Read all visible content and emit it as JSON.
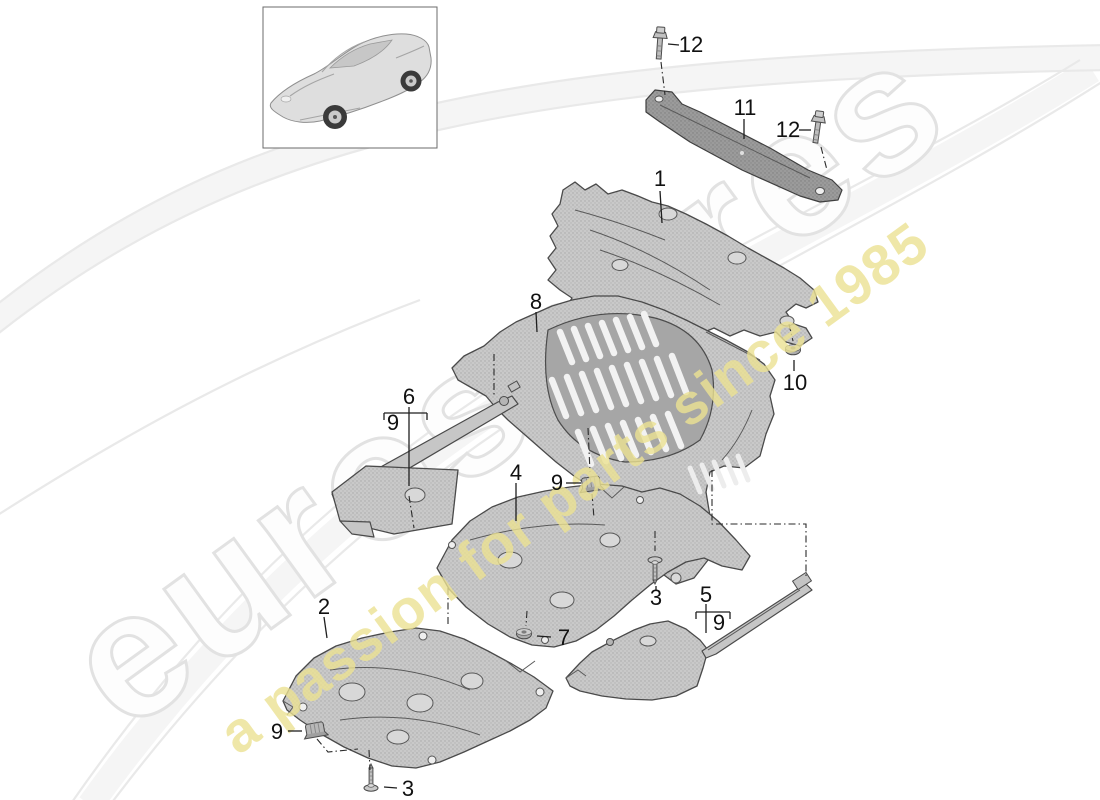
{
  "watermark": {
    "brand": "eurospares",
    "tagline": "a passion for parts since 1985",
    "brand_outline_color": "#e2e2e2",
    "tagline_color": "#ece293"
  },
  "colors": {
    "callout_text": "#111111",
    "part_fill": "#c9c9c9",
    "part_stroke": "#4a4a4a",
    "background": "#ffffff"
  },
  "diagram": {
    "callouts": {
      "p1": "1",
      "p2": "2",
      "p3a": "3",
      "p3b": "3",
      "p4": "4",
      "p5": "5",
      "p6": "6",
      "p7": "7",
      "p8": "8",
      "p9a": "9",
      "p9b": "9",
      "p9c": "9",
      "p9d": "9",
      "p10": "10",
      "p11": "11",
      "p12a": "12",
      "p12b": "12"
    }
  }
}
